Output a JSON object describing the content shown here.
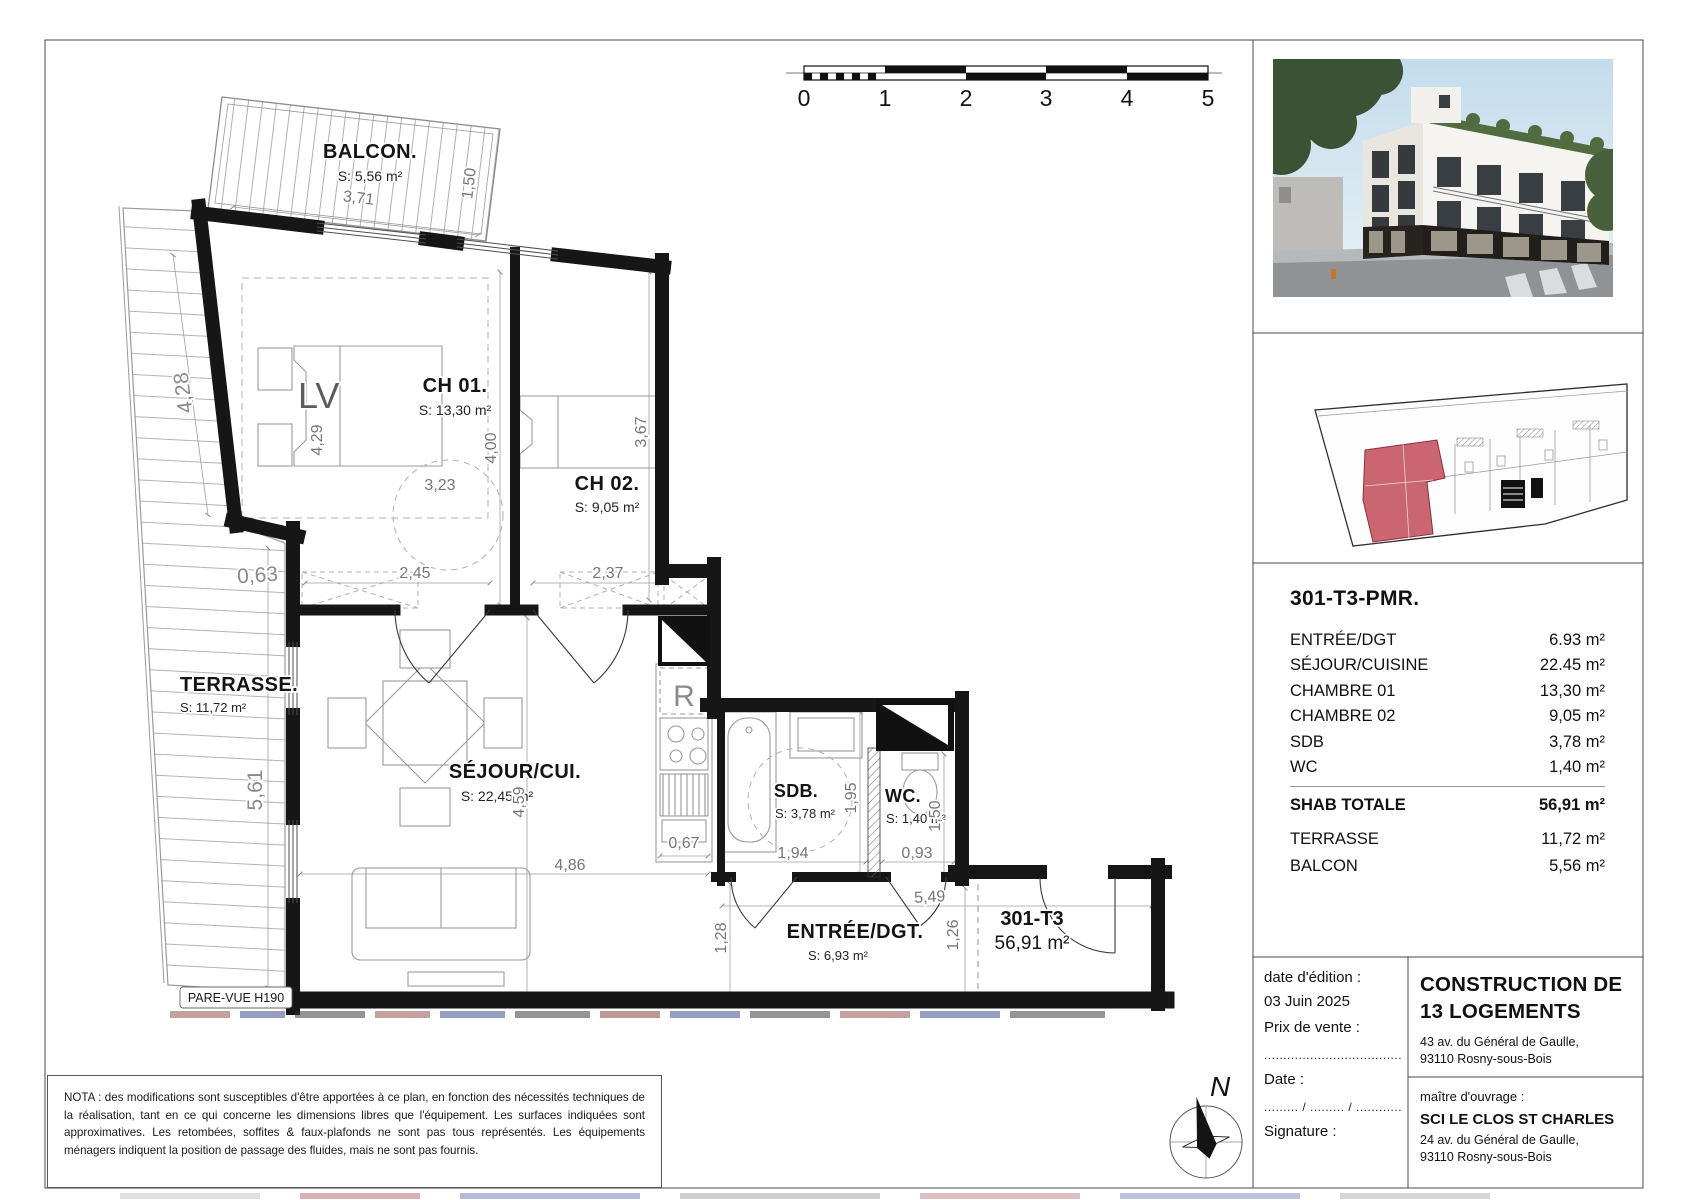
{
  "scalebar": {
    "ticks": [
      "0",
      "1",
      "2",
      "3",
      "4",
      "5"
    ]
  },
  "plan": {
    "rooms": {
      "balcon": {
        "name": "BALCON.",
        "area": "S: 5,56 m²"
      },
      "terrasse": {
        "name": "TERRASSE.",
        "area": "S: 11,72 m²"
      },
      "ch01": {
        "name": "CH 01.",
        "area": "S: 13,30 m²"
      },
      "ch02": {
        "name": "CH 02.",
        "area": "S: 9,05 m²"
      },
      "sejour": {
        "name": "SÉJOUR/CUI.",
        "area": "S: 22,45 m²"
      },
      "sdb": {
        "name": "SDB.",
        "area": "S: 3,78 m²"
      },
      "wc": {
        "name": "WC.",
        "area": "S: 1,40 m²"
      },
      "entree": {
        "name": "ENTRÉE/DGT.",
        "area": "S: 6,93 m²"
      }
    },
    "unit": {
      "name": "301-T3",
      "area": "56,91 m²"
    },
    "dims": {
      "balcon_w": "3,71",
      "balcon_d": "1,50",
      "terr_slant": "4,28",
      "terr_jog": "0,63",
      "terr_h": "5,61",
      "ch01_bed": "4,29",
      "ch01_w": "3,23",
      "ch01_h": "4,00",
      "ch01_door": "2,45",
      "ch02_door": "2,37",
      "ch02_h": "3,67",
      "sej_h": "4,59",
      "sej_w": "4,86",
      "kit": "0,67",
      "sdb_w": "1,94",
      "sdb_h": "1,95",
      "wc_w": "0,93",
      "wc_h": "1,50",
      "ent_w": "5,49",
      "ent_h1": "1,28",
      "ent_h2": "1,26"
    },
    "annotations": {
      "lv": "LV",
      "fridge": "R",
      "pare_vue": "PARE-VUE H190"
    }
  },
  "compass": {
    "north": "N"
  },
  "sidebar": {
    "unit_title": "301-T3-PMR.",
    "rows": [
      {
        "label": "ENTRÉE/DGT",
        "value": "6.93 m²"
      },
      {
        "label": "SÉJOUR/CUISINE",
        "value": "22.45 m²"
      },
      {
        "label": "CHAMBRE 01",
        "value": "13,30 m²"
      },
      {
        "label": "CHAMBRE 02",
        "value": "9,05 m²"
      },
      {
        "label": "SDB",
        "value": "3,78 m²"
      },
      {
        "label": "WC",
        "value": "1,40 m²"
      }
    ],
    "total": {
      "label": "SHAB TOTALE",
      "value": "56,91 m²"
    },
    "extras": [
      {
        "label": "TERRASSE",
        "value": "11,72 m²"
      },
      {
        "label": "BALCON",
        "value": "5,56 m²"
      }
    ]
  },
  "titleblock": {
    "date_label": "date d'édition :",
    "date_value": "03 Juin 2025",
    "price_label": "Prix de vente :",
    "price_dots": ".....................................",
    "date2_label": "Date :",
    "date2_dots": "......... / ......... / ............",
    "signature_label": "Signature :",
    "project_line1": "CONSTRUCTION DE",
    "project_line2": "13 LOGEMENTS",
    "project_addr1": "43 av. du Général de Gaulle,",
    "project_addr2": "93110 Rosny-sous-Bois",
    "owner_label": "maître d'ouvrage :",
    "owner_name": "SCI LE CLOS ST CHARLES",
    "owner_addr1": "24 av. du Général de Gaulle,",
    "owner_addr2": "93110 Rosny-sous-Bois"
  },
  "nota": "NOTA : des modifications sont susceptibles d'être apportées à ce plan, en fonction des nécessités techniques de la réalisation, tant en ce qui concerne les dimensions libres que l'équipement. Les surfaces indiquées sont approximatives. Les retombées, soffites & faux-plafonds ne sont pas tous représentés. Les équipements ménagers indiquent la position de passage des fluides, mais ne sont pas fournis.",
  "colors": {
    "wall": "#161616",
    "dim_text": "#7a7a7a",
    "unit_highlight": "#c35560",
    "sky": "#c3dcec"
  }
}
